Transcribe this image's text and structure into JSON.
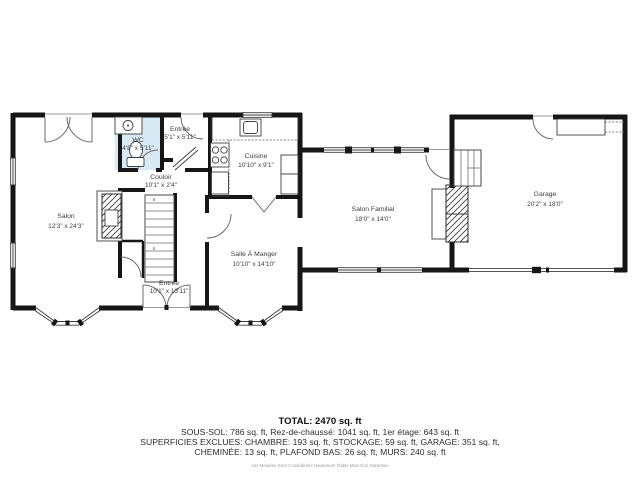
{
  "plan": {
    "rooms": {
      "salon": {
        "name": "Salon",
        "dims": "12'3\" x 24'3\""
      },
      "wc": {
        "name": "WC",
        "dims": "4'8\" x 5'11\""
      },
      "entree": {
        "name": "Entrée",
        "dims": "5'1\" x 5'11\""
      },
      "couloir": {
        "name": "Couloir",
        "dims": "10'1\" x 2'4\""
      },
      "cuisine": {
        "name": "Cuisine",
        "dims": "10'10\" x 9'1\""
      },
      "salle_a_manger": {
        "name": "Salle À Manger",
        "dims": "10'10\" x 14'10\""
      },
      "entree_foyer": {
        "name": "Entrée",
        "dims": "10'1\" x 13'11\""
      },
      "salon_familial": {
        "name": "Salon Familial",
        "dims": "18'0\" x 14'0\""
      },
      "garage": {
        "name": "Garage",
        "dims": "20'2\" x 18'0\""
      }
    },
    "stair_count_label": "5"
  },
  "footer": {
    "total": "TOTAL: 2470 sq. ft",
    "areas_line": "SOUS-SOL: 786 sq. ft, Rez-de-chaussé: 1041 sq. ft, 1er étage: 643 sq. ft",
    "excluded_line1": "SUPERFICIES EXCLUES: CHAMBRE: 193 sq. ft, STOCKAGE: 59 sq. ft, GARAGE: 351 sq. ft,",
    "excluded_line2": "CHEMINÉE: 13 sq. ft, PLAFOND BAS: 26 sq. ft, MURS: 240 sq. ft",
    "disclaimer": "Les Mesures Sont Considérées Hautement Fiable Mais Non Garanties"
  },
  "colors": {
    "wall": "#161616",
    "wc_fill": "#d8eaf6",
    "window_line": "#3c3c3c",
    "label_text": "#3d3d3d"
  }
}
